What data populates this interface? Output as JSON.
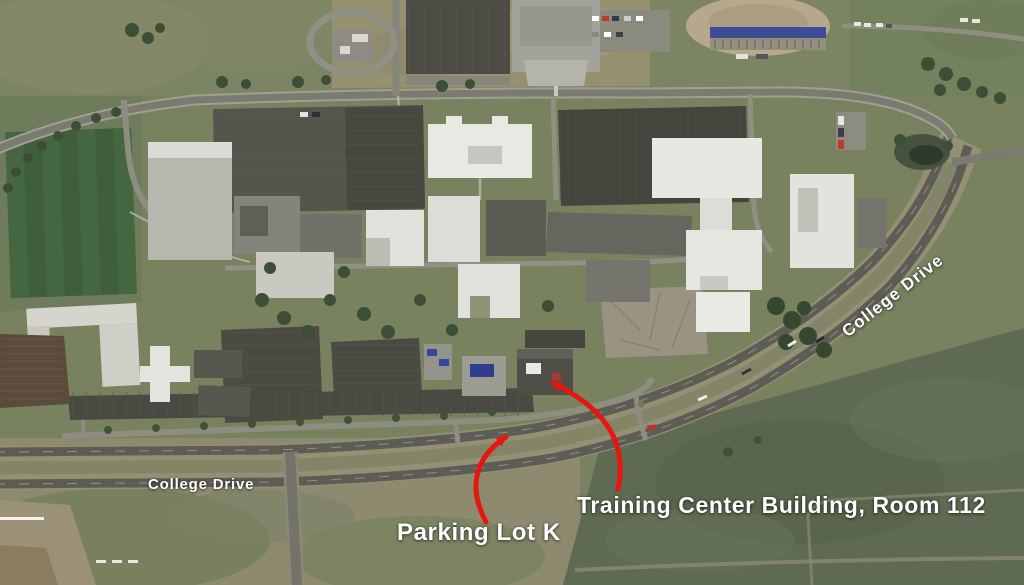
{
  "labels": {
    "college_drive_upper": "College Drive",
    "college_drive_lower": "College Drive",
    "parking_lot_k": "Parking Lot K",
    "training_center": "Training Center Building, Room 112"
  },
  "colors": {
    "annotation_arrow_red": "#e61710",
    "label_text_white": "#ffffff"
  }
}
